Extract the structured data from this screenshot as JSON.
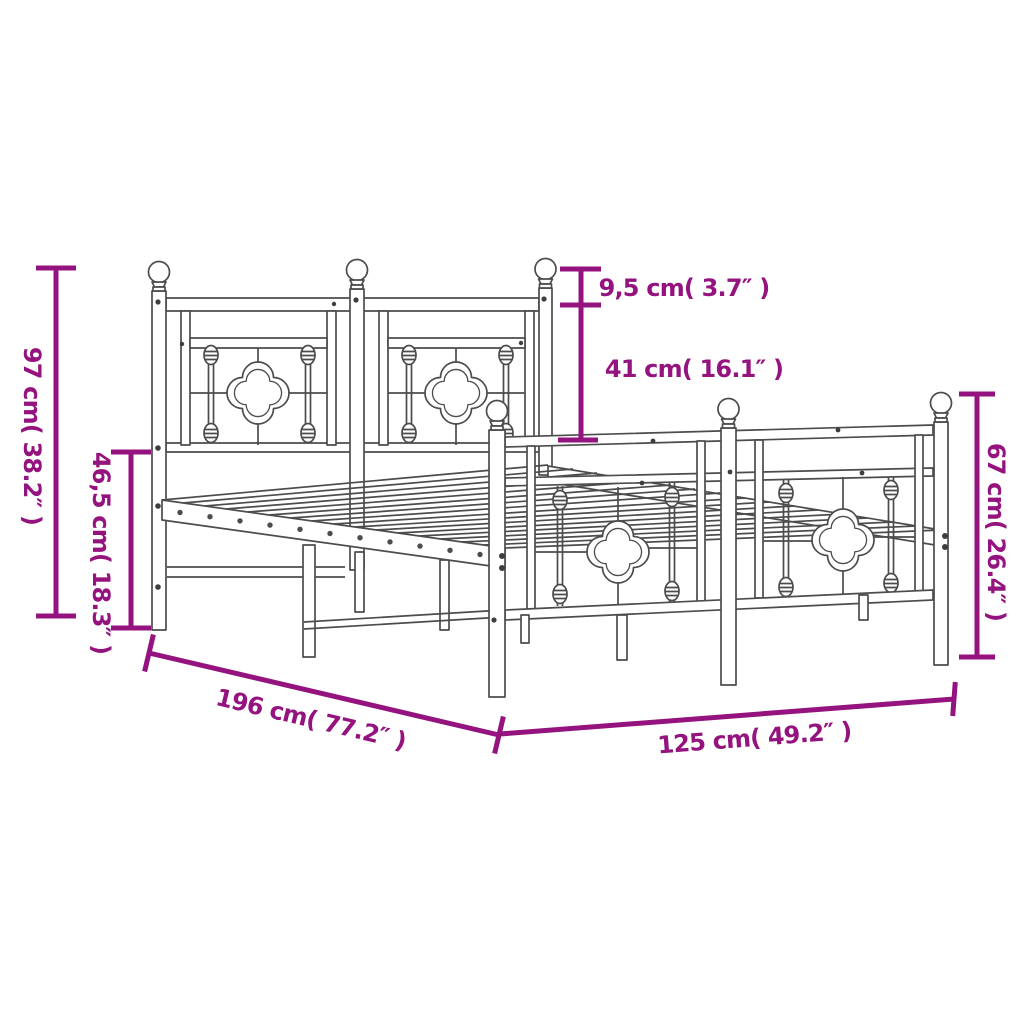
{
  "title": "Metal bed frame dimension diagram",
  "colors": {
    "dimension": "#94137f",
    "frame": "#4c4c4c",
    "background": "#ffffff"
  },
  "labels": {
    "headboard_height": "97 cm( 38.2″ )",
    "base_height": "46,5 cm( 18.3″ )",
    "finial_height": "9,5 cm( 3.7″ )",
    "headboard_panel_height": "41 cm( 16.1″ )",
    "footboard_height": "67 cm( 26.4″ )",
    "frame_length": "196 cm( 77.2″ )",
    "frame_width": "125 cm( 49.2″ )"
  }
}
